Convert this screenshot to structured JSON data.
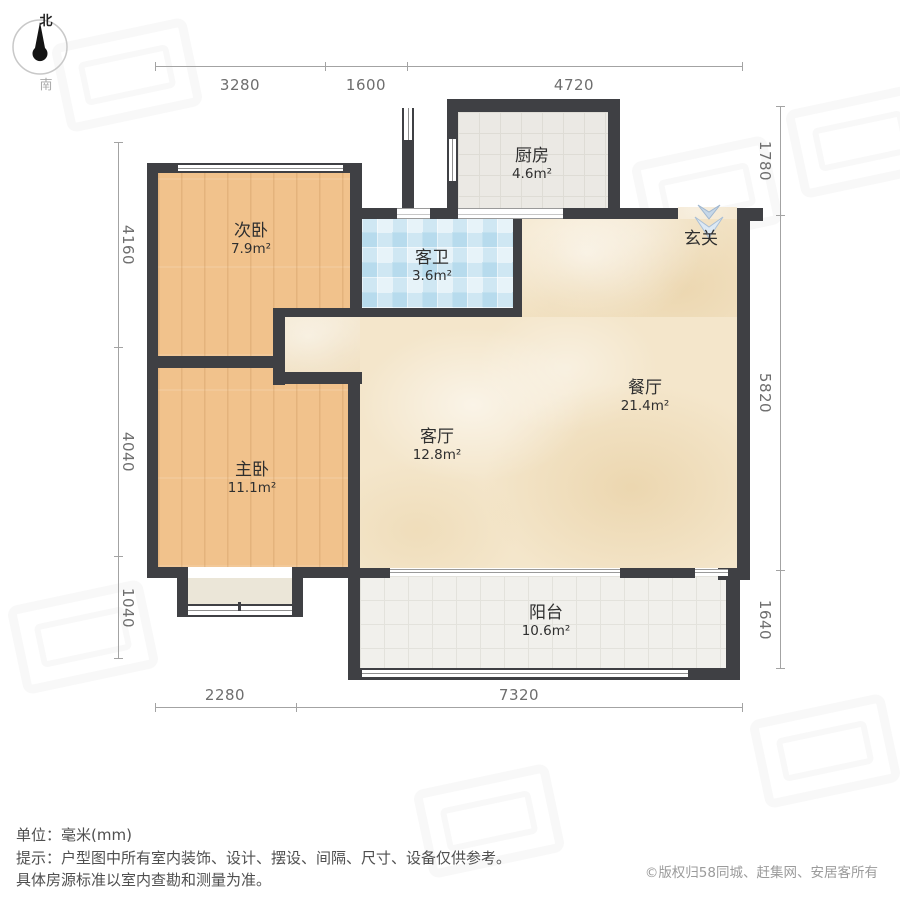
{
  "compass": {
    "north": "北",
    "south": "南"
  },
  "dimensions": {
    "top": [
      "3280",
      "1600",
      "4720"
    ],
    "left": [
      "4160",
      "4040",
      "1040"
    ],
    "right": [
      "1780",
      "5820",
      "1640"
    ],
    "bottom": [
      "2280",
      "7320"
    ]
  },
  "rooms": [
    {
      "name": "次卧",
      "area": "7.9m²"
    },
    {
      "name": "主卧",
      "area": "11.1m²"
    },
    {
      "name": "客厅",
      "area": "12.8m²"
    },
    {
      "name": "餐厅",
      "area": "21.4m²"
    },
    {
      "name": "厨房",
      "area": "4.6m²"
    },
    {
      "name": "客卫",
      "area": "3.6m²"
    },
    {
      "name": "阳台",
      "area": "10.6m²"
    },
    {
      "name": "玄关",
      "area": ""
    }
  ],
  "footer": {
    "unit_label": "单位：毫米(mm)",
    "tip_line1": "提示：户型图中所有室内装饰、设计、摆设、间隔、尺寸、设备仅供参考。",
    "tip_line2": "具体房源标准以室内查勘和测量为准。",
    "copyright": "©版权归58同城、赶集网、安居客所有"
  },
  "icons": {
    "compass_needle": "compass-needle",
    "entry_arrows": "entry-direction-arrows"
  },
  "colors": {
    "wall": "#3f4044",
    "wood_floor": "#f1c28c",
    "marble_floor": "#f4e6cb",
    "bath_tile": "#cfe7f3",
    "kitchen_tile": "#ebe9e4",
    "balcony_tile": "#f1f0ec",
    "dimension_text": "#6e6e6e",
    "entry_arrow": "#c6d7e8"
  }
}
